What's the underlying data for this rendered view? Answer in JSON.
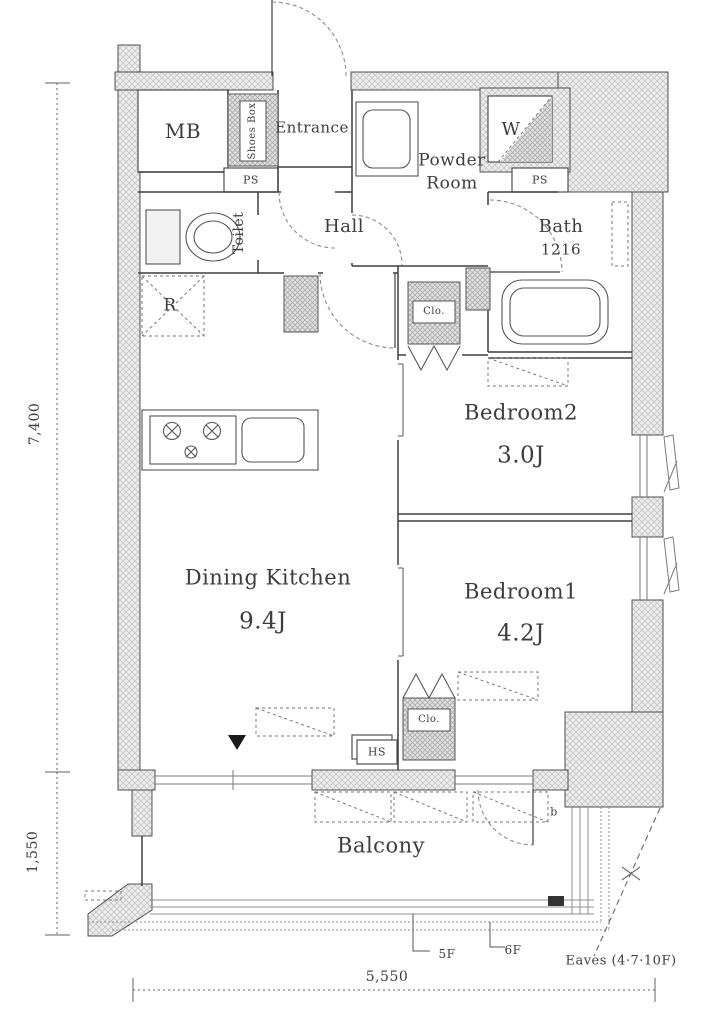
{
  "rooms": {
    "mb": "MB",
    "shoes_box": "Shoes Box",
    "entrance": "Entrance",
    "toilet": "Toilet",
    "hall": "Hall",
    "powder_room": {
      "line1": "Powder",
      "line2": "Room"
    },
    "washer": "W",
    "bath": "Bath",
    "bath_size": "1216",
    "refrigerator": "R",
    "closet_mid": "Clo.",
    "closet_bottom": "Clo.",
    "bedroom2": "Bedroom2",
    "bedroom2_size": "3.0J",
    "bedroom1": "Bedroom1",
    "bedroom1_size": "4.2J",
    "dining_kitchen": "Dining Kitchen",
    "dining_kitchen_size": "9.4J",
    "balcony": "Balcony"
  },
  "labels": {
    "ps_top": "PS",
    "ps_right": "PS",
    "hs": "HS",
    "door_b": "b"
  },
  "dimensions": {
    "left_upper": "7,400",
    "left_lower": "1,550",
    "bottom": "5,550"
  },
  "annotations": {
    "floor_5f": "5F",
    "floor_6f": "6F",
    "eaves": "Eaves (4·7·10F)"
  },
  "colors": {
    "ink": "#3d3d3d",
    "wall_line": "#4f4f4f",
    "wall_fill": "#ededed",
    "closet_fill": "#e3e3e3"
  }
}
